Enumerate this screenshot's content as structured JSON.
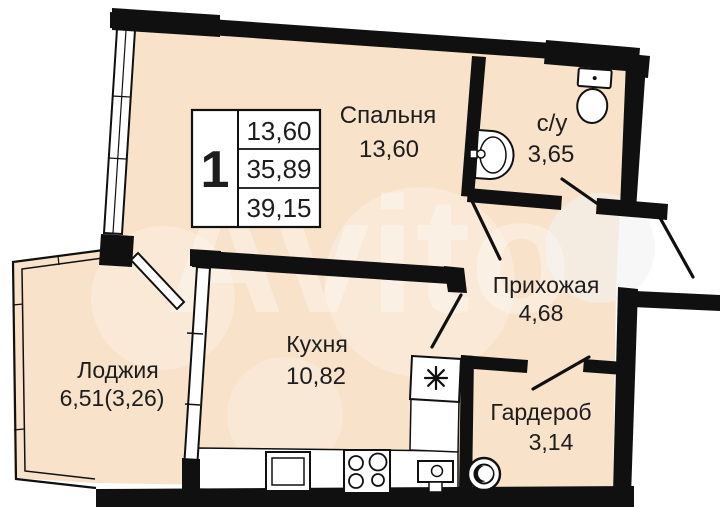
{
  "plan": {
    "title": "1-room apartment floor plan",
    "watermark": {
      "brand": "Avito"
    },
    "legend": {
      "rooms_count": "1",
      "rows": [
        "13,60",
        "35,89",
        "39,15"
      ]
    },
    "rooms": {
      "bedroom": {
        "name": "Спальня",
        "area": "13,60"
      },
      "bathroom": {
        "name": "с/у",
        "area": "3,65"
      },
      "hallway": {
        "name": "Прихожая",
        "area": "4,68"
      },
      "kitchen": {
        "name": "Кухня",
        "area": "10,82"
      },
      "loggia": {
        "name": "Лоджия",
        "area": "6,51(3,26)"
      },
      "wardrobe": {
        "name": "Гардероб",
        "area": "3,14"
      }
    },
    "icons": {
      "toilet": "toilet-icon",
      "washbasin": "washbasin-icon",
      "kitchen_sink": "kitchen-sink-icon",
      "stove": "stove-icon",
      "washing_machine": "washing-machine-icon",
      "vent": "vent-asterisk-icon"
    },
    "colors": {
      "room_fill": "#f8e2c9",
      "wall": "#101010",
      "text": "#1d1d1d",
      "watermark": "#ffffff"
    }
  }
}
